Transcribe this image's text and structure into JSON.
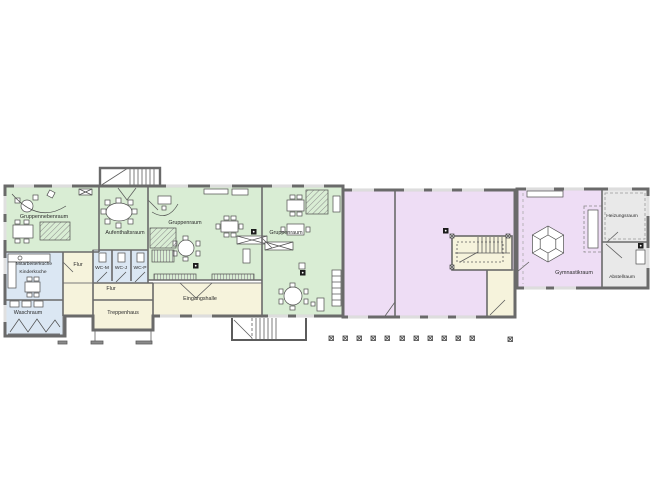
{
  "plan": {
    "kind": "architectural floor plan",
    "language": "de"
  },
  "colors": {
    "group_rooms": "#d9edd4",
    "circulation": "#f6f3dc",
    "sanitary_kitchen": "#dbe7f3",
    "halls_gym": "#eeddf5",
    "utility": "#e9e9e9",
    "walls": "#6a6a6a"
  },
  "rooms": [
    {
      "label": "Gruppennebenraum"
    },
    {
      "label": "Aufenthaltsraum"
    },
    {
      "label": "Gruppenraum"
    },
    {
      "label": "Gruppenraum"
    },
    {
      "label": "Mitarbeiterküche"
    },
    {
      "label": "Kinderküche"
    },
    {
      "label": "Flur"
    },
    {
      "label": "WC-M"
    },
    {
      "label": "WC-J"
    },
    {
      "label": "WC-P"
    },
    {
      "label": "Flur"
    },
    {
      "label": "Waschraum"
    },
    {
      "label": "Treppenhaus"
    },
    {
      "label": "Eingangshalle"
    },
    {
      "label": "Gymnastikraum"
    },
    {
      "label": "Heizungsraum"
    },
    {
      "label": "Abstellraum"
    }
  ],
  "site_markers": {
    "symbol": "crossed-square-post",
    "count": 12
  }
}
